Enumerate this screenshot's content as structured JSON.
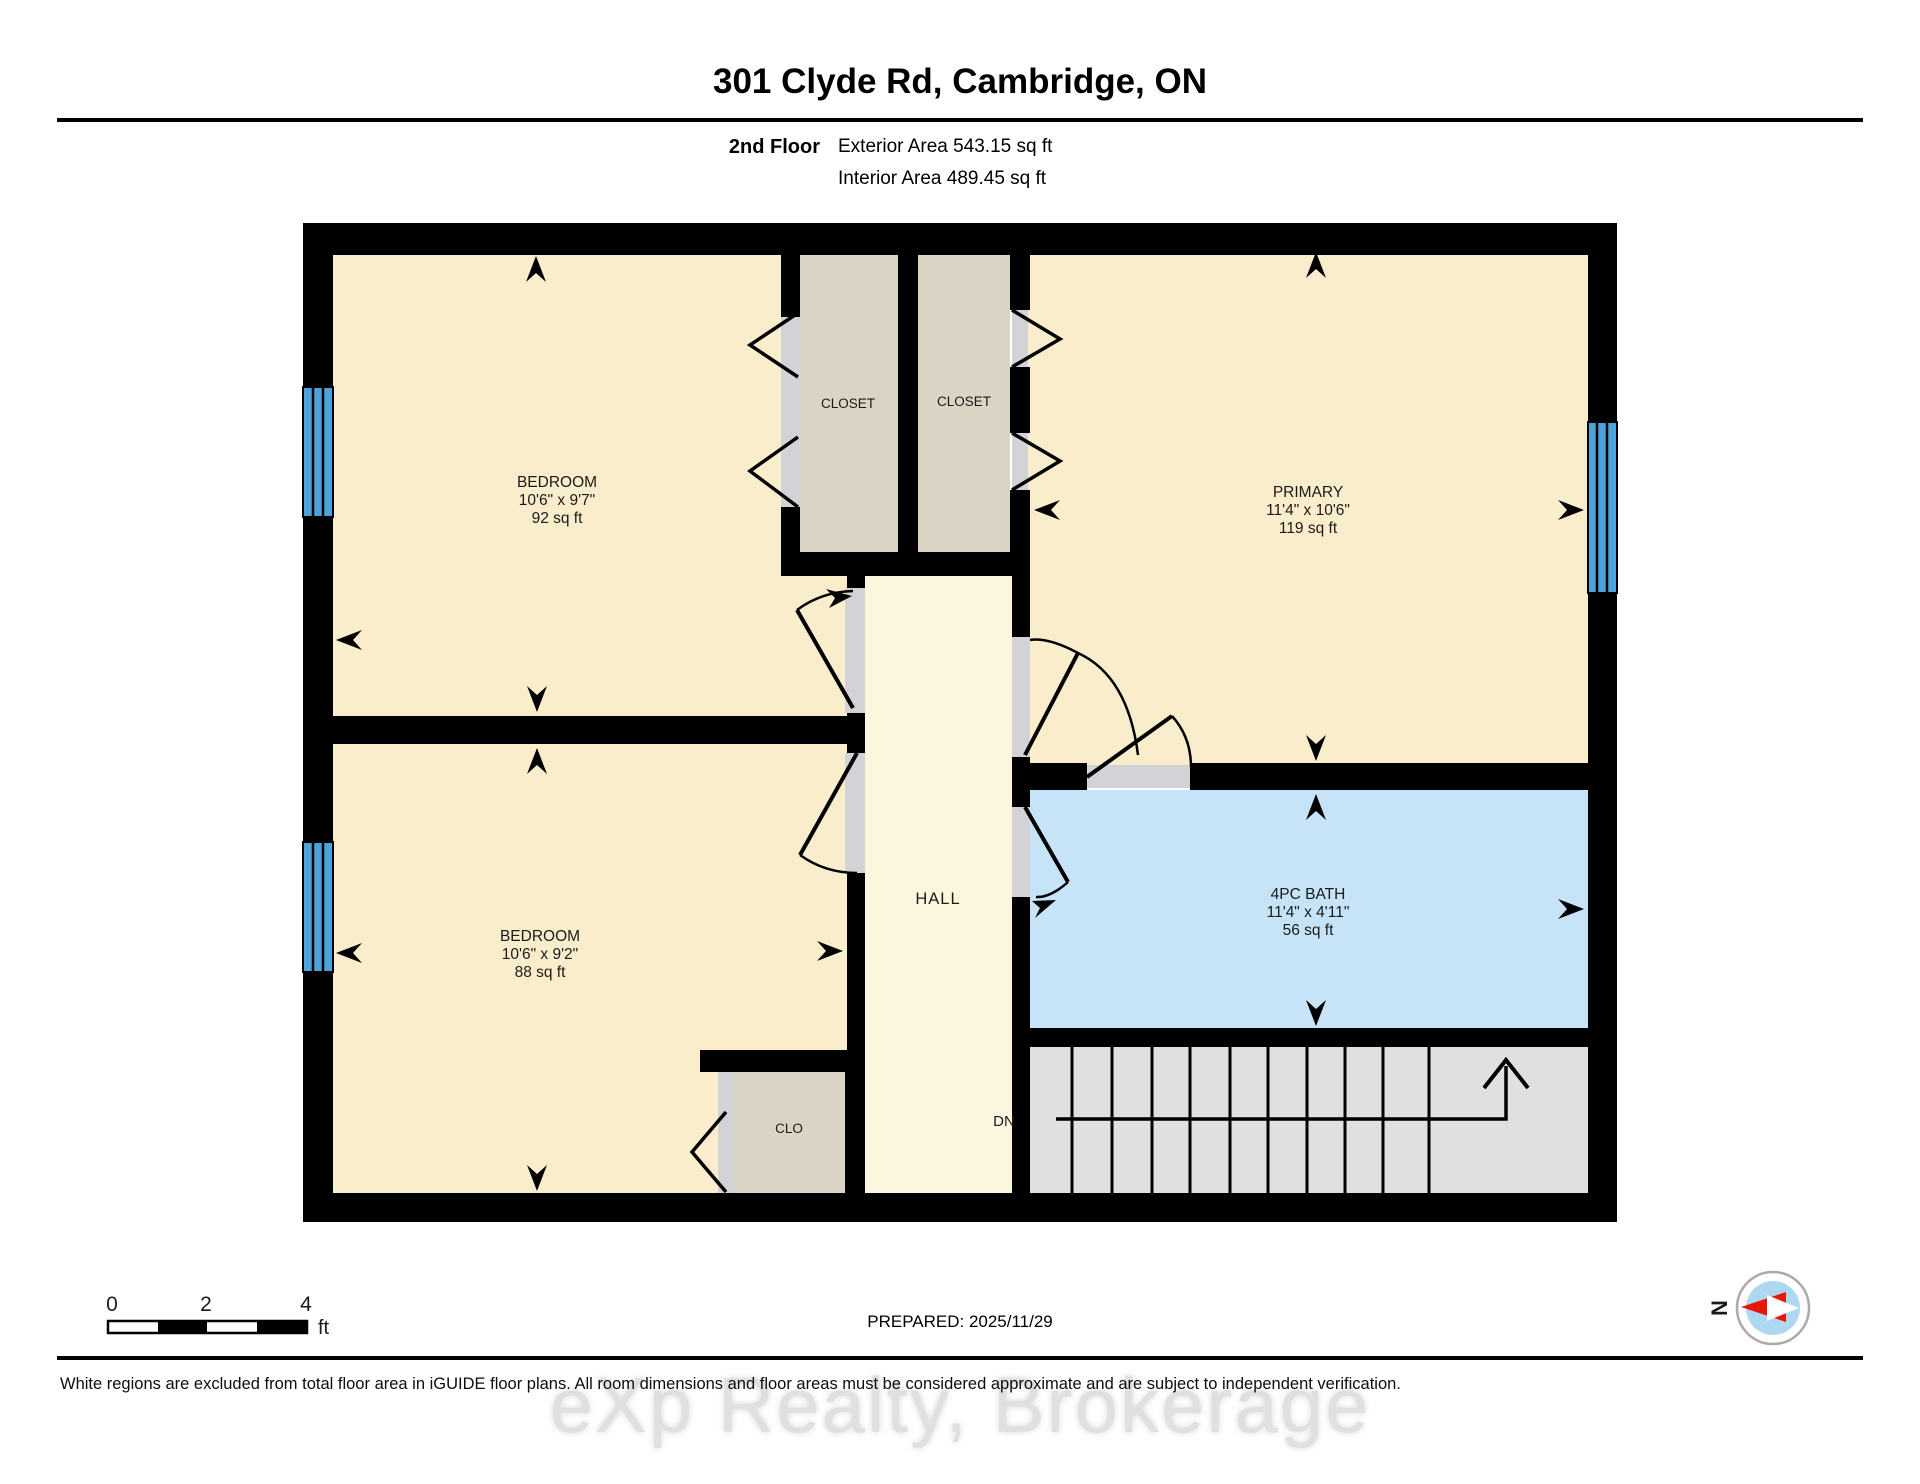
{
  "header": {
    "title": "301 Clyde Rd, Cambridge, ON",
    "floor_label": "2nd Floor",
    "exterior_area": "Exterior Area 543.15 sq ft",
    "interior_area": "Interior Area 489.45 sq ft"
  },
  "rooms": {
    "bedroom_top": {
      "name": "BEDROOM",
      "dims": "10'6\" x 9'7\"",
      "area": "92 sq ft"
    },
    "bedroom_bottom": {
      "name": "BEDROOM",
      "dims": "10'6\" x 9'2\"",
      "area": "88 sq ft"
    },
    "primary": {
      "name": "PRIMARY",
      "dims": "11'4\" x 10'6\"",
      "area": "119 sq ft"
    },
    "bath": {
      "name": "4PC BATH",
      "dims": "11'4\" x 4'11\"",
      "area": "56 sq ft"
    },
    "closet_left": {
      "name": "CLOSET"
    },
    "closet_right": {
      "name": "CLOSET"
    },
    "hall": {
      "name": "HALL"
    },
    "clo": {
      "name": "CLO"
    }
  },
  "stairs": {
    "label": "DN"
  },
  "scale_bar": {
    "tick0": "0",
    "tick2": "2",
    "tick4": "4",
    "unit": "ft"
  },
  "compass": {
    "north": "N"
  },
  "footer": {
    "prepared": "PREPARED: 2025/11/29",
    "disclaimer": "White regions are excluded from total floor area in iGUIDE floor plans. All room dimensions and floor areas must be considered approximate and are subject to independent verification.",
    "watermark": "eXp Realty, Brokerage"
  },
  "colors": {
    "wall": "#000000",
    "room_fill": "#FAEDCB",
    "hall_fill": "#FDF6DF",
    "closet_fill": "#DBD3C3",
    "bath_fill": "#C6E3F8",
    "stairs_fill": "#E0E0E0",
    "door_fill": "#D3D3D7",
    "window": "#4CA2D9",
    "compass_north": "#E8150B",
    "compass_inner": "#AED7F2"
  }
}
